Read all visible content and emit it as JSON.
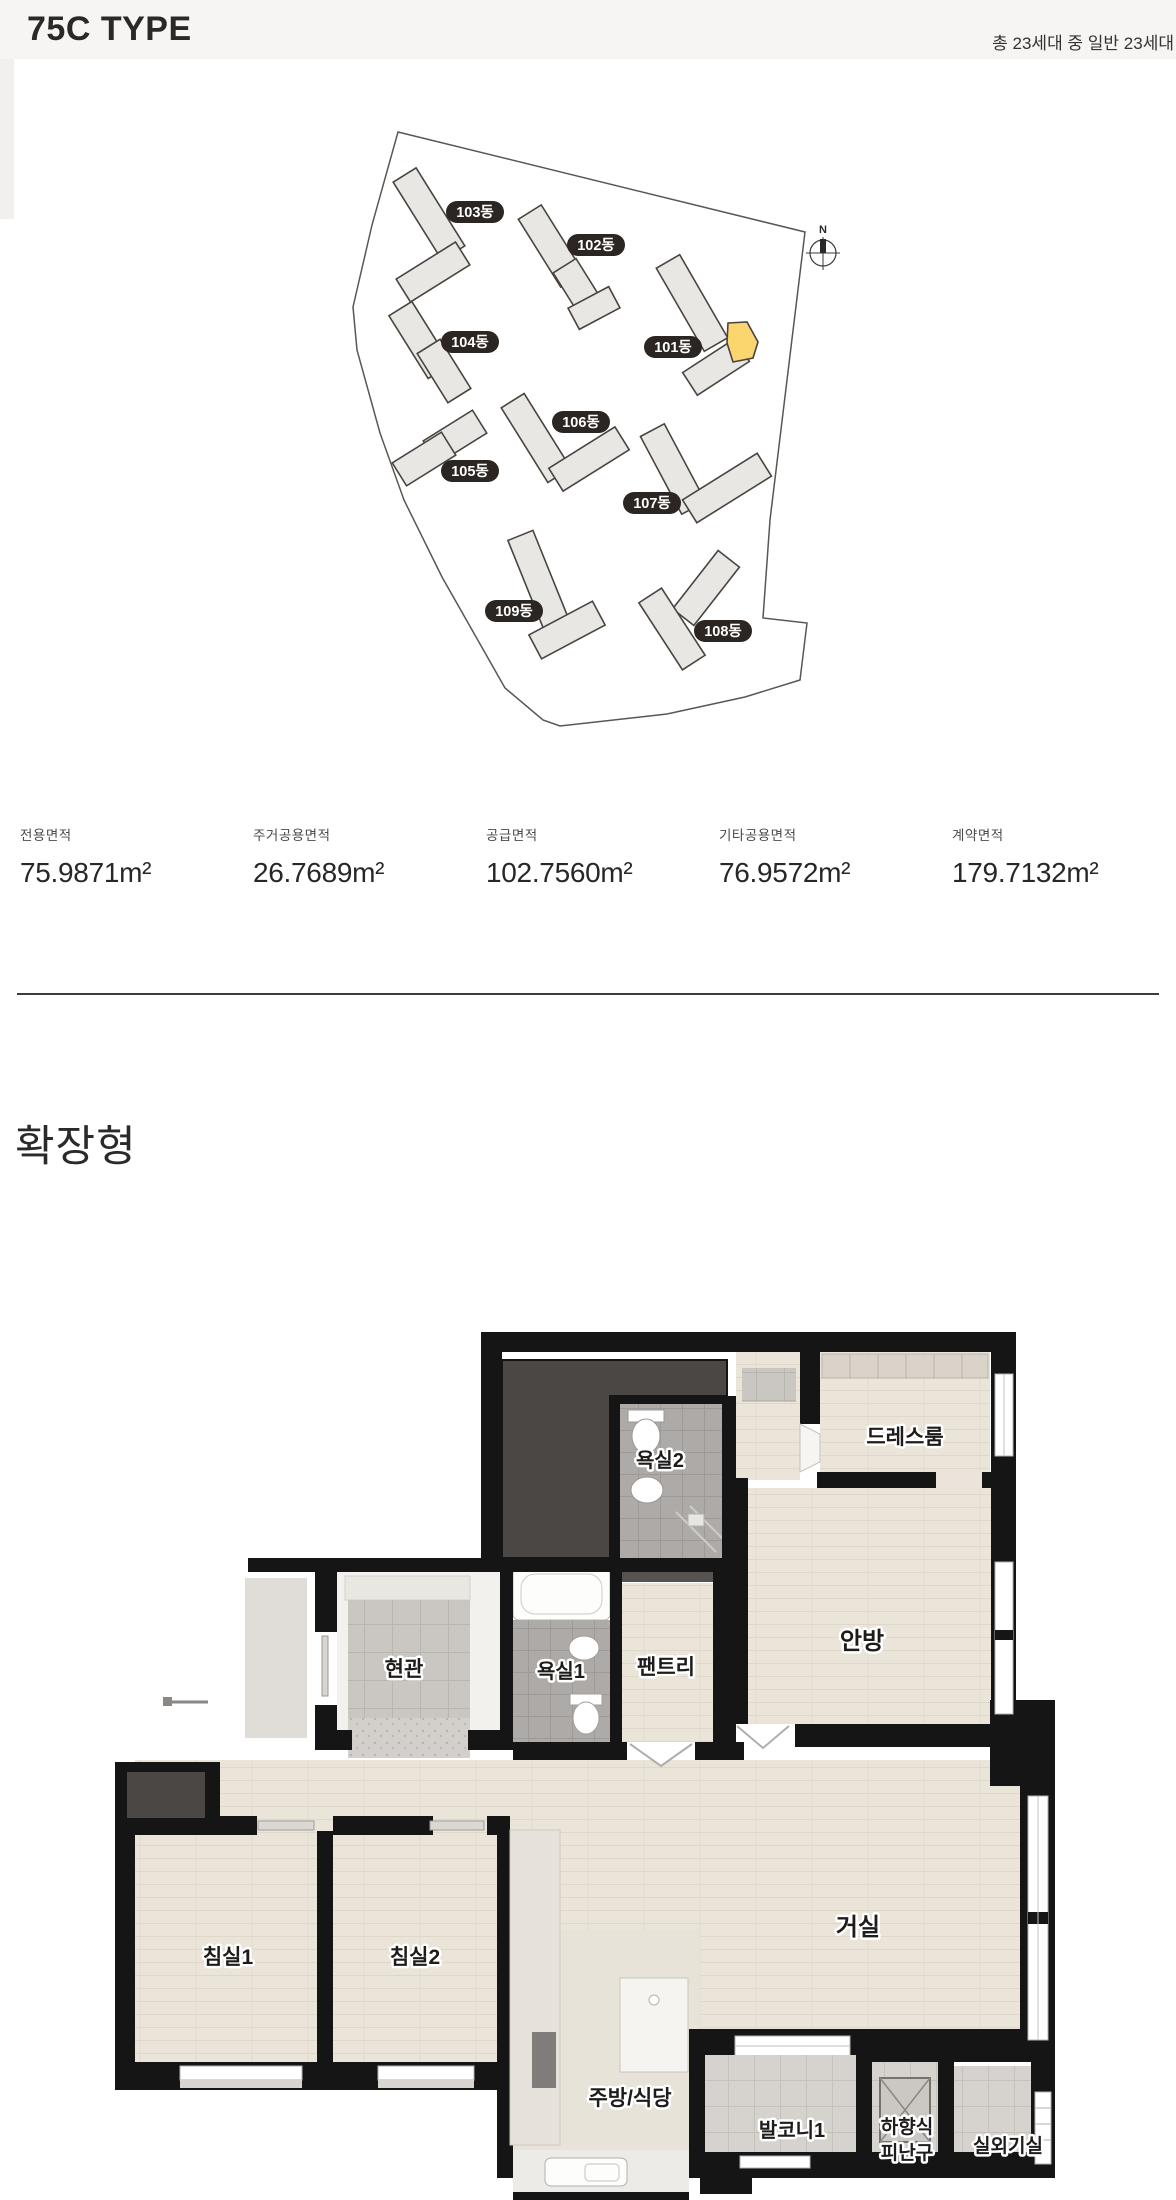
{
  "header": {
    "title": "75C TYPE",
    "summary": "총 23세대 중 일반 23세대"
  },
  "site_map": {
    "compass_label": "N",
    "highlight_color": "#fbd56e",
    "label_bg_color": "#2b2622",
    "buildings": [
      {
        "name": "103동",
        "x": 475,
        "y": 212
      },
      {
        "name": "102동",
        "x": 596,
        "y": 245
      },
      {
        "name": "104동",
        "x": 470,
        "y": 342
      },
      {
        "name": "101동",
        "x": 673,
        "y": 347
      },
      {
        "name": "106동",
        "x": 581,
        "y": 422
      },
      {
        "name": "105동",
        "x": 470,
        "y": 471
      },
      {
        "name": "107동",
        "x": 652,
        "y": 503
      },
      {
        "name": "109동",
        "x": 514,
        "y": 611
      },
      {
        "name": "108동",
        "x": 723,
        "y": 631
      }
    ]
  },
  "areas": {
    "items": [
      {
        "label": "전용면적",
        "value": "75.9871m²"
      },
      {
        "label": "주거공용면적",
        "value": "26.7689m²"
      },
      {
        "label": "공급면적",
        "value": "102.7560m²"
      },
      {
        "label": "기타공용면적",
        "value": "76.9572m²"
      },
      {
        "label": "계약면적",
        "value": "179.7132m²"
      }
    ]
  },
  "section": {
    "heading": "확장형"
  },
  "floor_plan": {
    "wall_color": "#151515",
    "rooms": [
      {
        "label": "욕실2",
        "x": 660,
        "y": 1467,
        "size": 20
      },
      {
        "label": "드레스룸",
        "x": 905,
        "y": 1444,
        "size": 21
      },
      {
        "label": "안방",
        "x": 862,
        "y": 1649,
        "size": 24
      },
      {
        "label": "현관",
        "x": 404,
        "y": 1676,
        "size": 21
      },
      {
        "label": "욕실1",
        "x": 561,
        "y": 1678,
        "size": 20
      },
      {
        "label": "팬트리",
        "x": 666,
        "y": 1674,
        "size": 21
      },
      {
        "label": "침실1",
        "x": 228,
        "y": 1964,
        "size": 21
      },
      {
        "label": "침실2",
        "x": 415,
        "y": 1964,
        "size": 21
      },
      {
        "label": "거실",
        "x": 858,
        "y": 1935,
        "size": 24
      },
      {
        "label": "주방/식당",
        "x": 630,
        "y": 2105,
        "size": 21
      },
      {
        "label": "발코니1",
        "x": 792,
        "y": 2137,
        "size": 20
      },
      {
        "lines": [
          "하향식",
          "피난구"
        ],
        "x": 907,
        "y": 2133,
        "size": 19
      },
      {
        "label": "실외기실",
        "x": 1008,
        "y": 2152,
        "size": 19
      }
    ]
  }
}
